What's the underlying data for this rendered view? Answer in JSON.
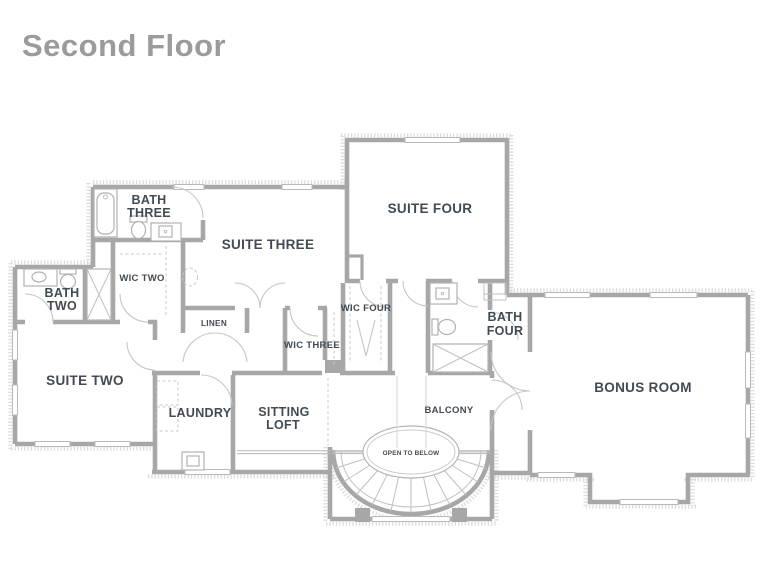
{
  "title": "Second Floor",
  "colors": {
    "title": "#9b9b9b",
    "wall": "#a7a7a7",
    "label": "#424b53",
    "hatch": "#dcdcdc",
    "fixture": "#b2b2b2"
  },
  "rooms": {
    "suite_two": "SUITE TWO",
    "suite_three": "SUITE THREE",
    "suite_four": "SUITE FOUR",
    "bonus_room": "BONUS ROOM",
    "bath_two_l1": "BATH",
    "bath_two_l2": "TWO",
    "bath_three_l1": "BATH",
    "bath_three_l2": "THREE",
    "bath_four_l1": "BATH",
    "bath_four_l2": "FOUR",
    "wic_two": "WIC TWO",
    "wic_three": "WIC THREE",
    "wic_four": "WIC FOUR",
    "linen": "LINEN",
    "laundry": "LAUNDRY",
    "sitting_loft_l1": "SITTING",
    "sitting_loft_l2": "LOFT",
    "balcony": "BALCONY",
    "open_to_below": "OPEN TO BELOW"
  }
}
